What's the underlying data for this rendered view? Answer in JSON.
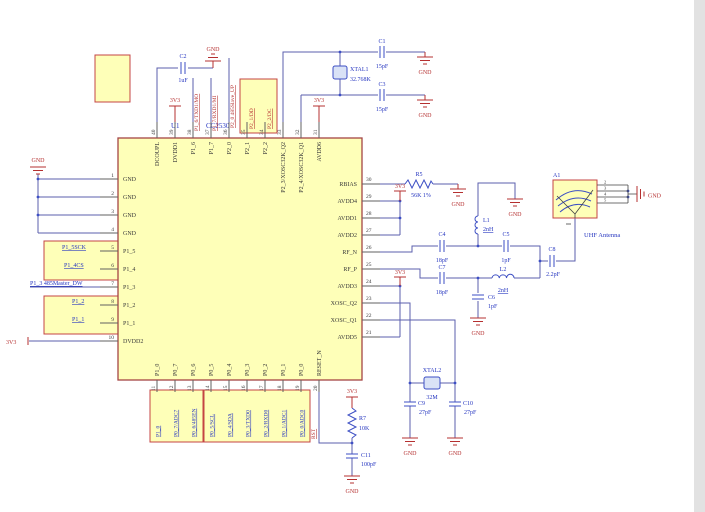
{
  "schematic": {
    "chip": {
      "refdes": "U1",
      "part": "CC2530",
      "left_pins": [
        {
          "num": "1",
          "name": "GND"
        },
        {
          "num": "2",
          "name": "GND"
        },
        {
          "num": "3",
          "name": "GND"
        },
        {
          "num": "4",
          "name": "GND"
        },
        {
          "num": "5",
          "name": "P1_5"
        },
        {
          "num": "6",
          "name": "P1_4"
        },
        {
          "num": "7",
          "name": "P1_3"
        },
        {
          "num": "8",
          "name": "P1_2"
        },
        {
          "num": "9",
          "name": "P1_1"
        },
        {
          "num": "10",
          "name": "DVDD2"
        }
      ],
      "top_pins": [
        {
          "num": "40",
          "name": "DCOUPL"
        },
        {
          "num": "39",
          "name": "DVDD1"
        },
        {
          "num": "38",
          "name": "P1_6"
        },
        {
          "num": "37",
          "name": "P1_7"
        },
        {
          "num": "36",
          "name": "P2_0"
        },
        {
          "num": "35",
          "name": "P2_1"
        },
        {
          "num": "34",
          "name": "P2_2"
        },
        {
          "num": "33",
          "name": "P2_3/XOSC32K_Q2"
        },
        {
          "num": "32",
          "name": "P2_4/XOSC32K_Q1"
        },
        {
          "num": "31",
          "name": "AVDD6"
        }
      ],
      "right_pins": [
        {
          "num": "30",
          "name": "RBIAS"
        },
        {
          "num": "29",
          "name": "AVDD4"
        },
        {
          "num": "28",
          "name": "AVDD1"
        },
        {
          "num": "27",
          "name": "AVDD2"
        },
        {
          "num": "26",
          "name": "RF_N"
        },
        {
          "num": "25",
          "name": "RF_P"
        },
        {
          "num": "24",
          "name": "AVDD3"
        },
        {
          "num": "23",
          "name": "XOSC_Q2"
        },
        {
          "num": "22",
          "name": "XOSC_Q1"
        },
        {
          "num": "21",
          "name": "AVDD5"
        }
      ],
      "bottom_pins": [
        {
          "num": "11",
          "name": "P1_0"
        },
        {
          "num": "12",
          "name": "P0_7"
        },
        {
          "num": "13",
          "name": "P0_6"
        },
        {
          "num": "14",
          "name": "P0_5"
        },
        {
          "num": "15",
          "name": "P0_4"
        },
        {
          "num": "16",
          "name": "P0_3"
        },
        {
          "num": "17",
          "name": "P0_2"
        },
        {
          "num": "18",
          "name": "P0_1"
        },
        {
          "num": "19",
          "name": "P0_0"
        },
        {
          "num": "20",
          "name": "RESET_N"
        }
      ]
    },
    "net_labels": {
      "left": [
        "P1_5SCK",
        "P1_4CS",
        "P1_3 485Master_DW",
        "P1_2",
        "P1_1"
      ],
      "top": [
        "P1_6/TXD1/MO",
        "P1_7/RXD1/MI",
        "P2_0 485Slave_UP",
        "P2_1/DD",
        "P2_2/DC"
      ],
      "bottom": [
        "P1_0",
        "P0_7/ADC7",
        "P0_6/485EN",
        "P0_5/SCL",
        "P0_4/SDA",
        "P0_3/TXD0",
        "P0_2/RXD0",
        "P0_1/ADC1",
        "P0_0/ADC0"
      ],
      "reset": "RST"
    },
    "power": {
      "v33": "3V3",
      "gnd": "GND"
    },
    "components": {
      "C1": {
        "ref": "C1",
        "value": "15pF"
      },
      "C2": {
        "ref": "C2",
        "value": "1uF"
      },
      "C3": {
        "ref": "C3",
        "value": "15pF"
      },
      "C4": {
        "ref": "C4",
        "value": "18pF"
      },
      "C5": {
        "ref": "C5",
        "value": "1pF"
      },
      "C6": {
        "ref": "C6",
        "value": "1pF"
      },
      "C7": {
        "ref": "C7",
        "value": "18pF"
      },
      "C8": {
        "ref": "C8",
        "value": "2.2pF"
      },
      "C9": {
        "ref": "C9",
        "value": "27pF"
      },
      "C10": {
        "ref": "C10",
        "value": "27pF"
      },
      "C11": {
        "ref": "C11",
        "value": "100pF"
      },
      "R5": {
        "ref": "R5",
        "value": "56K 1%"
      },
      "R7": {
        "ref": "R7",
        "value": "10K"
      },
      "L1": {
        "ref": "L1",
        "value": "2nH"
      },
      "L2": {
        "ref": "L2",
        "value": "2nH"
      },
      "XTAL1": {
        "ref": "XTAL1",
        "value": "32.768K"
      },
      "XTAL2": {
        "ref": "XTAL2",
        "value": "32M"
      },
      "A1": {
        "ref": "A1",
        "desc": "UHF Antenna",
        "pin_numbers": [
          "2",
          "3",
          "4",
          "5"
        ]
      }
    }
  }
}
